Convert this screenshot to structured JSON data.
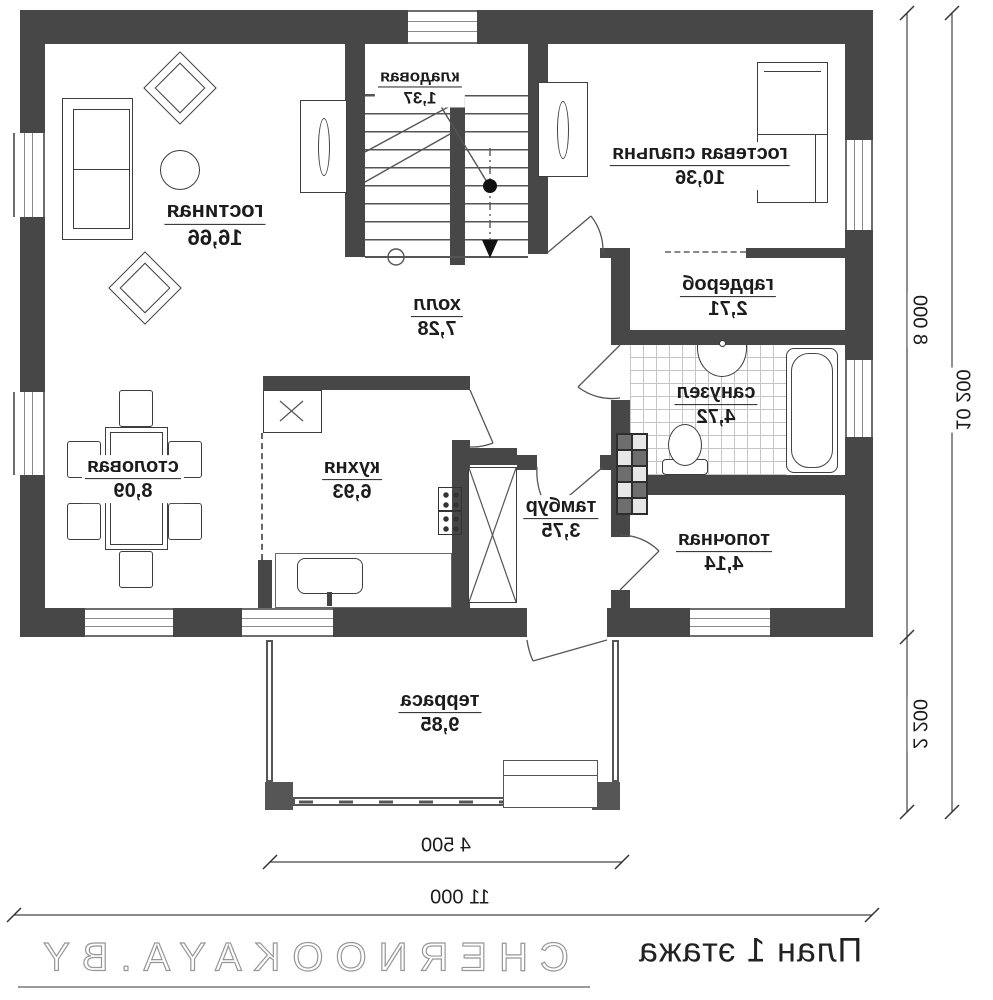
{
  "plan": {
    "title": "План 1 этажа",
    "watermark": "CHERNOOKAYA.BY"
  },
  "rooms": [
    {
      "name": "гостиная",
      "area": "16,66"
    },
    {
      "name": "кладовая",
      "area": "1,37"
    },
    {
      "name": "гостевая спальня",
      "area": "10,36"
    },
    {
      "name": "гардероб",
      "area": "2,71"
    },
    {
      "name": "холл",
      "area": "7,28"
    },
    {
      "name": "санузел",
      "area": "4,72"
    },
    {
      "name": "топочная",
      "area": "4,14"
    },
    {
      "name": "столовая",
      "area": "8,09"
    },
    {
      "name": "кухня",
      "area": "6,93"
    },
    {
      "name": "тамбур",
      "area": "3,75"
    },
    {
      "name": "терраса",
      "area": "9,85"
    }
  ],
  "dimensions": {
    "terrace_width": "4 500",
    "house_width": "11 000",
    "house_depth": "8 000",
    "total_depth": "10 200",
    "terrace_depth": "2 200"
  },
  "colors": {
    "wall": "#474747",
    "line": "#555555",
    "watermark_outline": "#979797"
  }
}
